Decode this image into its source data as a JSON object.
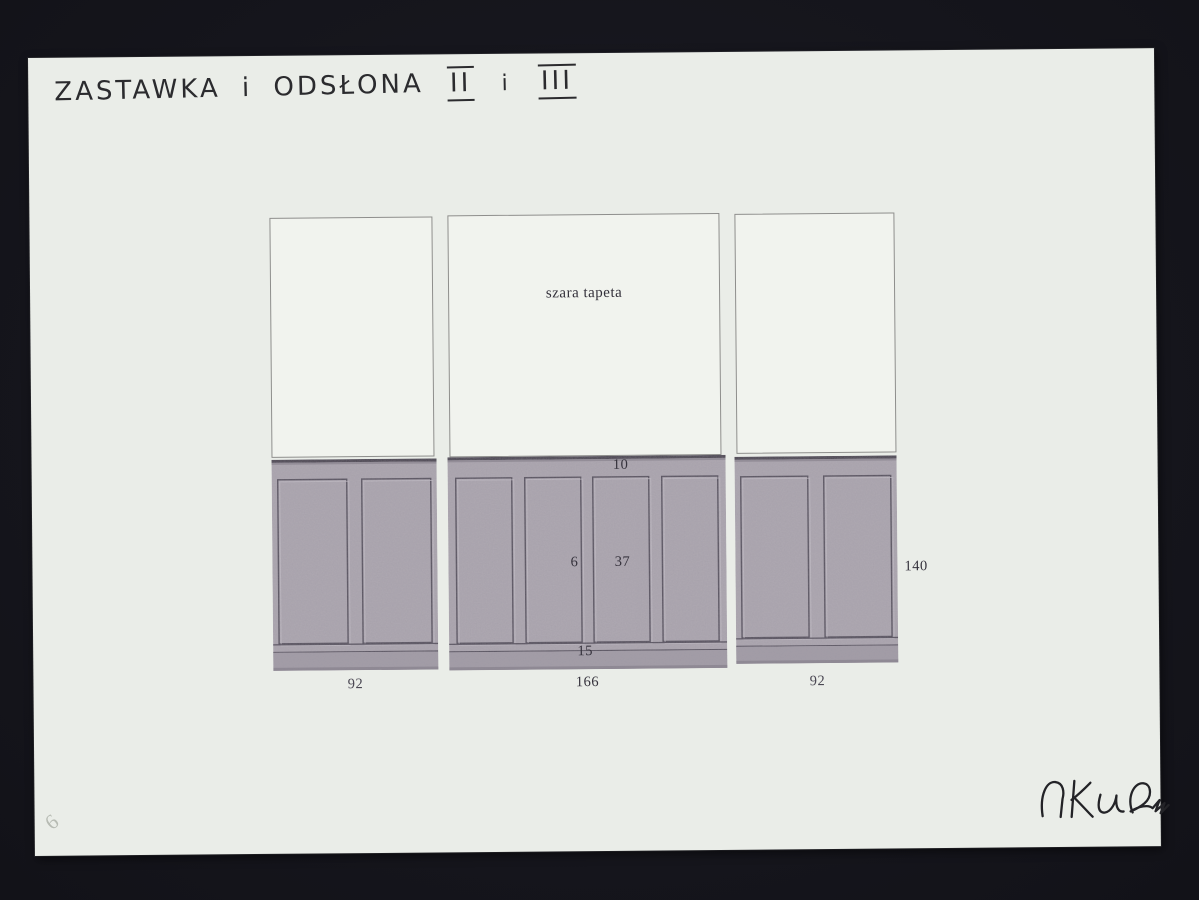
{
  "document": {
    "title": {
      "text": "ZASTAWKA i ODSŁONA",
      "numeral_a": "II",
      "conjunction": "i",
      "numeral_b": "III"
    },
    "corner_mark": "6"
  },
  "drawing": {
    "left_panel": {
      "width_label": "92"
    },
    "center_panel": {
      "wallpaper_label": "szara tapeta",
      "top_rail_height": "10",
      "stile_width": "6",
      "panel_width": "37",
      "base_height": "15",
      "width_label": "166"
    },
    "right_panel": {
      "width_label": "92",
      "height_label": "140"
    }
  },
  "colors": {
    "scan_background": "#17171e",
    "paper": "#eaede8",
    "wallpaper_white": "#f1f3ee",
    "wainscot_gray": "#a7a1ab",
    "wainscot_line": "#57525e",
    "ink": "#2b2b2e",
    "label_ink": "#35323c"
  }
}
